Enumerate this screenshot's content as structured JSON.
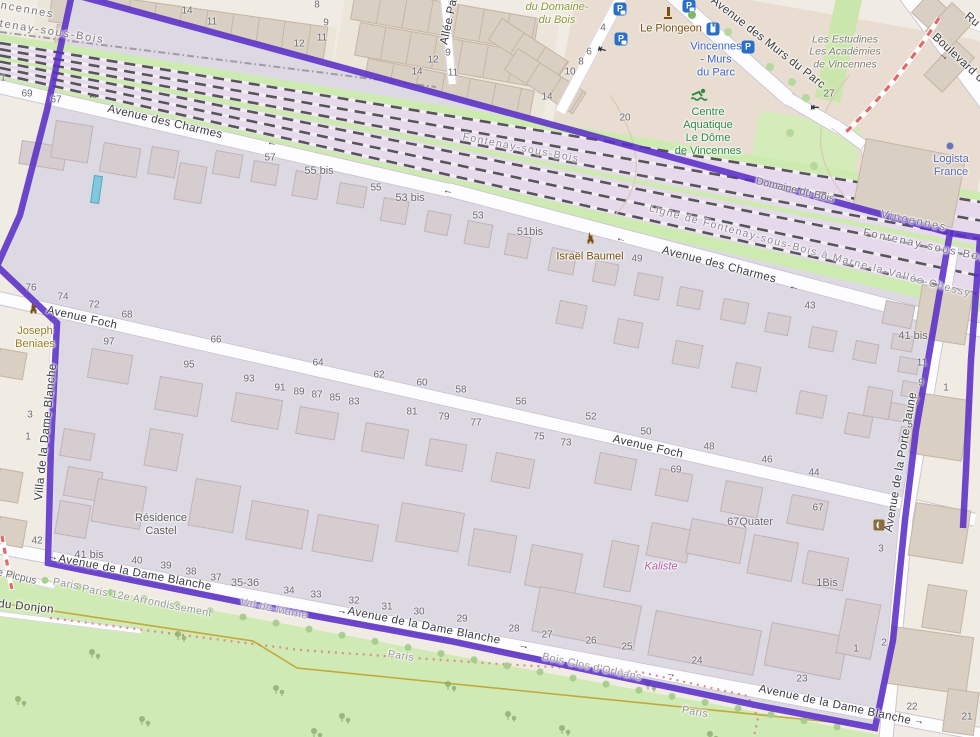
{
  "map": {
    "colors": {
      "boundary": "#5a2fc6",
      "selected_area_fill": "#dcd9e3",
      "park_green": "#cfeab4",
      "railway_area": "#e5d9eb",
      "construction_line": "#e06a6a",
      "paris_boundary_line": "#bfa22e",
      "water_pool": "#7fc8dd"
    },
    "streets": [
      {
        "label": "Avenue des Charmes",
        "x": 165,
        "y": 122,
        "rot": 13,
        "cls": "street"
      },
      {
        "label": "Avenue des Charmes",
        "x": 719,
        "y": 265,
        "rot": 14.5,
        "cls": "street"
      },
      {
        "label": "Avenue Foch",
        "x": 82,
        "y": 318,
        "rot": 12.5,
        "cls": "street"
      },
      {
        "label": "Avenue Foch",
        "x": 648,
        "y": 447,
        "rot": 12.8,
        "cls": "street"
      },
      {
        "label": "Avenue de la Dame Blanche",
        "x": 135,
        "y": 573,
        "rot": 10.5,
        "cls": "street"
      },
      {
        "label": "Avenue de la Dame Blanche",
        "x": 424,
        "y": 626,
        "rot": 11,
        "cls": "street"
      },
      {
        "label": "Avenue de la Dame Blanche",
        "x": 835,
        "y": 705,
        "rot": 12,
        "cls": "street"
      },
      {
        "label": "Avenue des Murs du Parc",
        "x": 768,
        "y": 43,
        "rot": 38,
        "cls": "street"
      },
      {
        "label": "Boulevard d",
        "x": 958,
        "y": 58,
        "rot": 43,
        "cls": "street"
      },
      {
        "label": "Ru",
        "x": 972,
        "y": 20,
        "rot": 40,
        "cls": "street"
      },
      {
        "label": "Allée Pa",
        "x": 449,
        "y": 22,
        "rot": -78,
        "cls": "street"
      },
      {
        "label": "Villa de la Dame Blanche",
        "x": 46,
        "y": 432,
        "rot": -84,
        "cls": "street"
      },
      {
        "label": "Avenue de la Porte Jaune",
        "x": 901,
        "y": 462,
        "rot": -80,
        "cls": "street"
      },
      {
        "label": "Domaine du Bois",
        "x": 795,
        "y": 190,
        "rot": 13,
        "cls": "minor"
      },
      {
        "label": "du Donjon",
        "x": 26,
        "y": 607,
        "rot": 6,
        "cls": "street"
      },
      {
        "label": "de Picpus",
        "x": 14,
        "y": 576,
        "rot": 13,
        "cls": "minor"
      },
      {
        "label": "Val-de-Marne",
        "x": 274,
        "y": 609,
        "rot": 12,
        "cls": "admin2"
      },
      {
        "label": "Paris",
        "x": 66,
        "y": 584,
        "rot": 10,
        "cls": "admin2"
      },
      {
        "label": "Paris",
        "x": 401,
        "y": 656,
        "rot": 9,
        "cls": "admin2"
      },
      {
        "label": "Paris",
        "x": 695,
        "y": 712,
        "rot": 10,
        "cls": "admin2"
      },
      {
        "label": "Paris 12e Arrondissement",
        "x": 147,
        "y": 601,
        "rot": 11,
        "cls": "admin2"
      },
      {
        "label": "Bois Clos d'Orléans",
        "x": 592,
        "y": 667,
        "rot": 12,
        "cls": "admin2"
      },
      {
        "label": "Fontenay-sous-Bois",
        "x": 521,
        "y": 148,
        "rot": 11,
        "cls": "rail"
      },
      {
        "label": "Ligne de Fontenay-sous-Bois à Marne-la-Vallée-Chessy",
        "x": 810,
        "y": 251,
        "rot": 15,
        "cls": "rail"
      },
      {
        "label": "Vincennes",
        "x": 21,
        "y": 9,
        "rot": 10,
        "cls": "admin"
      },
      {
        "label": "Fontenay-sous-Bois",
        "x": 40,
        "y": 30,
        "rot": 9,
        "cls": "admin"
      },
      {
        "label": "Vincennes",
        "x": 914,
        "y": 221,
        "rot": 12,
        "cls": "admin"
      },
      {
        "label": "Fontenay-sous-Bois",
        "x": 927,
        "y": 246,
        "rot": 12,
        "cls": "admin"
      }
    ],
    "places": [
      {
        "lines": [
          "du Domaine-",
          "du Bois"
        ],
        "x": 557,
        "y": 14,
        "cls": "wood"
      },
      {
        "lines": [
          "Le Plongeon"
        ],
        "x": 671,
        "y": 29,
        "cls": "poi-brown"
      },
      {
        "lines": [
          "Vincennes",
          "- Murs",
          "du Parc"
        ],
        "x": 716,
        "y": 60,
        "cls": "station"
      },
      {
        "lines": [
          "Les Estudines",
          "Les Académies",
          "de Vincennes"
        ],
        "x": 845,
        "y": 52,
        "cls": "estate"
      },
      {
        "lines": [
          "Logista",
          "France"
        ],
        "x": 951,
        "y": 166,
        "cls": "company"
      },
      {
        "lines": [
          "Centre",
          "Aquatique",
          "Le Dôme",
          "de Vincennes"
        ],
        "x": 708,
        "y": 132,
        "cls": "sports"
      },
      {
        "lines": [
          "Israël Baumel"
        ],
        "x": 590,
        "y": 257,
        "cls": "poi-brown"
      },
      {
        "lines": [
          "Joseph",
          "Beniaes"
        ],
        "x": 35,
        "y": 338,
        "cls": "poi-gold"
      },
      {
        "lines": [
          "Résidence",
          "Castel"
        ],
        "x": 161,
        "y": 525,
        "cls": "residence"
      },
      {
        "lines": [
          "Kaliste"
        ],
        "x": 661,
        "y": 567,
        "cls": "kaliste"
      }
    ],
    "house_numbers": [
      {
        "t": "14",
        "x": 187,
        "y": 11
      },
      {
        "t": "11",
        "x": 212,
        "y": 22
      },
      {
        "t": "8",
        "x": 317,
        "y": 5
      },
      {
        "t": "9",
        "x": 326,
        "y": 23
      },
      {
        "t": "11",
        "x": 322,
        "y": 38
      },
      {
        "t": "12",
        "x": 299,
        "y": 44
      },
      {
        "t": "9",
        "x": 448,
        "y": 53
      },
      {
        "t": "12",
        "x": 433,
        "y": 60
      },
      {
        "t": "14",
        "x": 417,
        "y": 72
      },
      {
        "t": "11",
        "x": 453,
        "y": 73
      },
      {
        "t": "4",
        "x": 603,
        "y": 28
      },
      {
        "t": "6",
        "x": 589,
        "y": 52
      },
      {
        "t": "8",
        "x": 581,
        "y": 62
      },
      {
        "t": "10",
        "x": 570,
        "y": 72
      },
      {
        "t": "14",
        "x": 547,
        "y": 97
      },
      {
        "t": "20",
        "x": 625,
        "y": 118
      },
      {
        "t": "27",
        "x": 829,
        "y": 94
      },
      {
        "t": "1",
        "x": 3,
        "y": 78
      },
      {
        "t": "69",
        "x": 27,
        "y": 94
      },
      {
        "t": "67",
        "x": 56,
        "y": 100
      },
      {
        "t": "57",
        "x": 270,
        "y": 158
      },
      {
        "t": "55 bis",
        "x": 319,
        "y": 171
      },
      {
        "t": "55",
        "x": 376,
        "y": 188
      },
      {
        "t": "53 bis",
        "x": 410,
        "y": 198
      },
      {
        "t": "53",
        "x": 478,
        "y": 216
      },
      {
        "t": "51bis",
        "x": 530,
        "y": 232
      },
      {
        "t": "49",
        "x": 637,
        "y": 259
      },
      {
        "t": "43",
        "x": 810,
        "y": 306
      },
      {
        "t": "76",
        "x": 31,
        "y": 288
      },
      {
        "t": "74",
        "x": 63,
        "y": 297
      },
      {
        "t": "72",
        "x": 94,
        "y": 305
      },
      {
        "t": "68",
        "x": 127,
        "y": 315
      },
      {
        "t": "66",
        "x": 216,
        "y": 340
      },
      {
        "t": "64",
        "x": 318,
        "y": 363
      },
      {
        "t": "62",
        "x": 379,
        "y": 375
      },
      {
        "t": "60",
        "x": 422,
        "y": 383
      },
      {
        "t": "58",
        "x": 461,
        "y": 390
      },
      {
        "t": "56",
        "x": 521,
        "y": 402
      },
      {
        "t": "52",
        "x": 591,
        "y": 417
      },
      {
        "t": "50",
        "x": 646,
        "y": 432
      },
      {
        "t": "48",
        "x": 709,
        "y": 447
      },
      {
        "t": "46",
        "x": 767,
        "y": 460
      },
      {
        "t": "44",
        "x": 814,
        "y": 473
      },
      {
        "t": "97",
        "x": 109,
        "y": 342
      },
      {
        "t": "95",
        "x": 189,
        "y": 365
      },
      {
        "t": "93",
        "x": 249,
        "y": 379
      },
      {
        "t": "91",
        "x": 280,
        "y": 388
      },
      {
        "t": "89",
        "x": 299,
        "y": 392
      },
      {
        "t": "87",
        "x": 317,
        "y": 395
      },
      {
        "t": "85",
        "x": 335,
        "y": 398
      },
      {
        "t": "83",
        "x": 354,
        "y": 402
      },
      {
        "t": "81",
        "x": 412,
        "y": 412
      },
      {
        "t": "79",
        "x": 444,
        "y": 417
      },
      {
        "t": "77",
        "x": 476,
        "y": 423
      },
      {
        "t": "75",
        "x": 539,
        "y": 437
      },
      {
        "t": "73",
        "x": 566,
        "y": 443
      },
      {
        "t": "69",
        "x": 676,
        "y": 470
      },
      {
        "t": "67",
        "x": 818,
        "y": 508
      },
      {
        "t": "67Quater",
        "x": 750,
        "y": 522
      },
      {
        "t": "1Bis",
        "x": 827,
        "y": 583
      },
      {
        "t": "3",
        "x": 881,
        "y": 549
      },
      {
        "t": "41 bis",
        "x": 913,
        "y": 336
      },
      {
        "t": "11",
        "x": 922,
        "y": 363
      },
      {
        "t": "9",
        "x": 921,
        "y": 383
      },
      {
        "t": "7",
        "x": 917,
        "y": 402
      },
      {
        "t": "5",
        "x": 910,
        "y": 425
      },
      {
        "t": "1",
        "x": 946,
        "y": 388
      },
      {
        "t": "3",
        "x": 30,
        "y": 415
      },
      {
        "t": "1",
        "x": 28,
        "y": 437
      },
      {
        "t": "42",
        "x": 37,
        "y": 541
      },
      {
        "t": "41 bis",
        "x": 89,
        "y": 555
      },
      {
        "t": "40",
        "x": 137,
        "y": 561
      },
      {
        "t": "39",
        "x": 166,
        "y": 566
      },
      {
        "t": "38",
        "x": 191,
        "y": 572
      },
      {
        "t": "37",
        "x": 216,
        "y": 578
      },
      {
        "t": "35-36",
        "x": 245,
        "y": 583
      },
      {
        "t": "34",
        "x": 289,
        "y": 591
      },
      {
        "t": "33",
        "x": 316,
        "y": 595
      },
      {
        "t": "32",
        "x": 354,
        "y": 601
      },
      {
        "t": "31",
        "x": 387,
        "y": 607
      },
      {
        "t": "30",
        "x": 419,
        "y": 612
      },
      {
        "t": "29",
        "x": 462,
        "y": 619
      },
      {
        "t": "28",
        "x": 514,
        "y": 629
      },
      {
        "t": "27",
        "x": 547,
        "y": 635
      },
      {
        "t": "26",
        "x": 591,
        "y": 641
      },
      {
        "t": "25",
        "x": 627,
        "y": 647
      },
      {
        "t": "24",
        "x": 697,
        "y": 661
      },
      {
        "t": "23",
        "x": 802,
        "y": 679
      },
      {
        "t": "1",
        "x": 856,
        "y": 649
      },
      {
        "t": "2",
        "x": 884,
        "y": 643
      },
      {
        "t": "22",
        "x": 912,
        "y": 707
      },
      {
        "t": "21",
        "x": 967,
        "y": 717
      }
    ],
    "arrows": [
      {
        "g": "←",
        "x": 93,
        "y": 96,
        "rot": 11
      },
      {
        "g": "←",
        "x": 272,
        "y": 143,
        "rot": 11
      },
      {
        "g": "←",
        "x": 448,
        "y": 191,
        "rot": 11
      },
      {
        "g": "←",
        "x": 621,
        "y": 239,
        "rot": 12
      },
      {
        "g": "←",
        "x": 794,
        "y": 287,
        "rot": 12
      },
      {
        "g": "→",
        "x": 53,
        "y": 557,
        "rot": 10
      },
      {
        "g": "→",
        "x": 342,
        "y": 611,
        "rot": 11
      },
      {
        "g": "→",
        "x": 524,
        "y": 646,
        "rot": 11
      },
      {
        "g": "→",
        "x": 671,
        "y": 674,
        "rot": 11
      },
      {
        "g": "→",
        "x": 919,
        "y": 721,
        "rot": 12
      },
      {
        "g": "→",
        "x": 944,
        "y": 56,
        "rot": 40
      },
      {
        "g": "⇤",
        "x": 602,
        "y": 50,
        "rot": 15
      },
      {
        "g": "⇤",
        "x": 815,
        "y": 108,
        "rot": 0
      }
    ],
    "icons": [
      {
        "name": "parking-motorcycle-icon",
        "type": "p-var",
        "glyph": "P",
        "x": 620,
        "y": 9
      },
      {
        "name": "parking-bicycle-icon",
        "type": "p-var",
        "glyph": "P",
        "x": 621,
        "y": 39
      },
      {
        "name": "parking-icon",
        "type": "p-var",
        "glyph": "P",
        "x": 689,
        "y": 6
      },
      {
        "name": "parking-icon",
        "type": "p",
        "glyph": "P",
        "x": 748,
        "y": 47
      },
      {
        "name": "charging-station-icon",
        "type": "plug",
        "x": 713,
        "y": 29
      },
      {
        "name": "fountain-icon",
        "type": "fountain",
        "x": 668,
        "y": 13
      },
      {
        "name": "memorial-icon",
        "type": "obelisk",
        "x": 590,
        "y": 238
      },
      {
        "name": "memorial-icon",
        "type": "obelisk",
        "x": 33,
        "y": 308
      },
      {
        "name": "artwork-icon",
        "type": "artwork",
        "x": 879,
        "y": 525
      },
      {
        "name": "swimmer-icon",
        "type": "swimmer",
        "x": 700,
        "y": 97
      },
      {
        "name": "company-dot-icon",
        "type": "cdot",
        "x": 950,
        "y": 146
      },
      {
        "name": "tree-dot-icon",
        "type": "gdot",
        "x": 692,
        "y": 15
      }
    ]
  }
}
